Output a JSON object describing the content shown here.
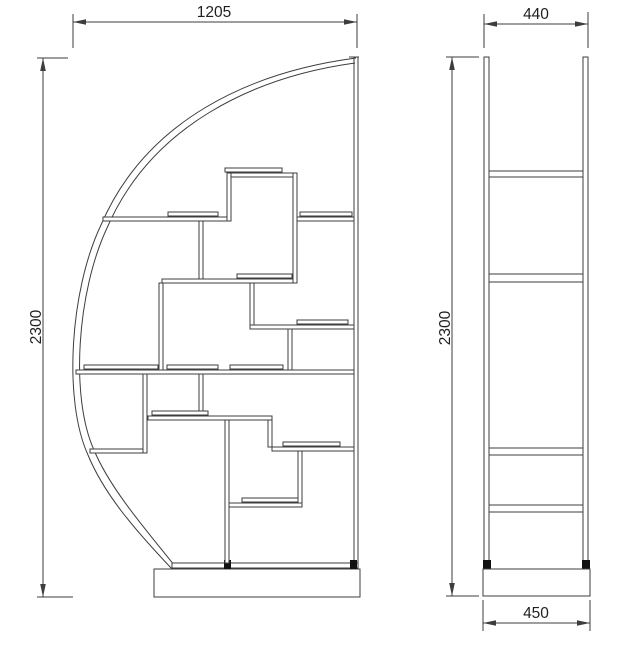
{
  "drawing": {
    "title": "shelf-unit-technical-drawing",
    "views": {
      "front": {
        "label": "front-view",
        "dimensions": {
          "width": "1205",
          "height": "2300"
        }
      },
      "side": {
        "label": "side-view",
        "dimensions": {
          "top_width": "440",
          "height": "2300",
          "base_width": "450"
        }
      }
    },
    "colors": {
      "background": "#ffffff",
      "line": "#3d3d3d",
      "text": "#1f1f1f",
      "foot": "#111111"
    }
  }
}
